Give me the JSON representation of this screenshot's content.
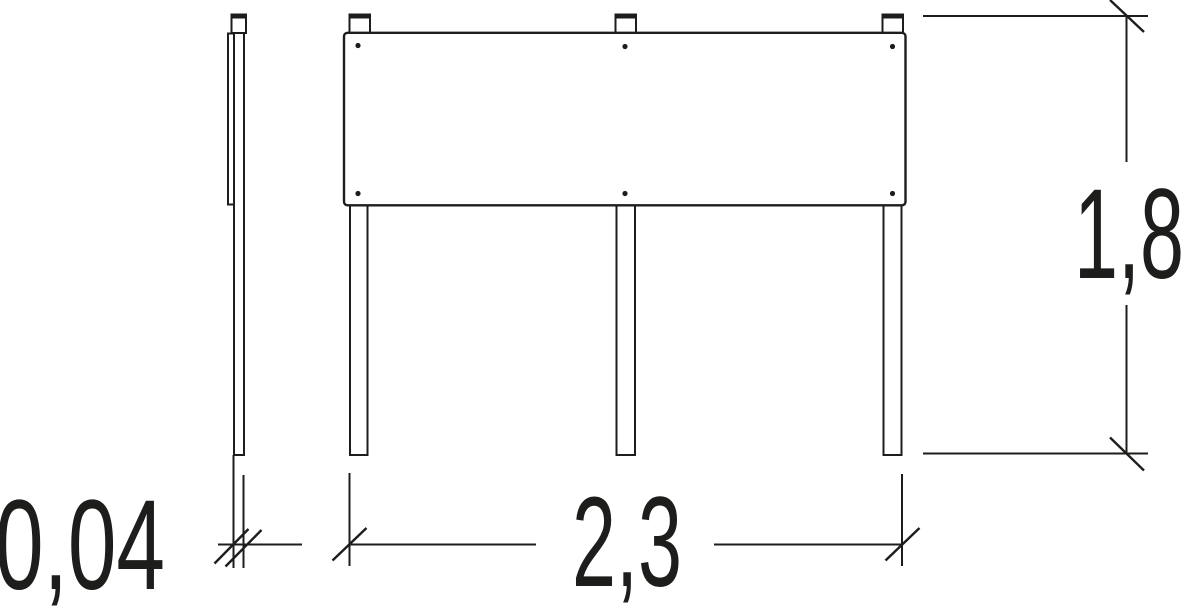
{
  "colors": {
    "line": "#1d1d1b",
    "background": "#ffffff"
  },
  "dimension_labels": {
    "thickness": "0,04",
    "width": "2,3",
    "height": "1,8"
  }
}
